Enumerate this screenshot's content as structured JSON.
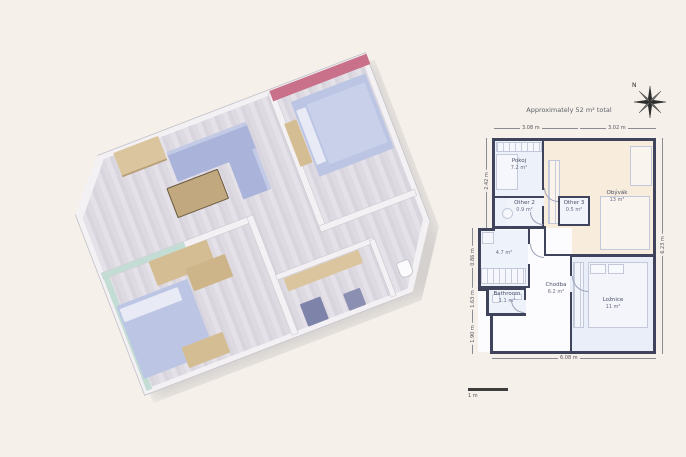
{
  "page": {
    "background": "#f5f1ea"
  },
  "plan2d": {
    "title": "Approximately 52 m² total",
    "compass_label": "N",
    "scale_label": "1 m",
    "rooms": [
      {
        "name": "Pokoj",
        "area": "7.2 m²"
      },
      {
        "name": "Obývák",
        "area": "13 m²"
      },
      {
        "name": "Other 2",
        "area": "0.9 m²"
      },
      {
        "name": "Other 3",
        "area": "0.5 m²"
      },
      {
        "name": "",
        "area": "4.7 m²"
      },
      {
        "name": "Chodba",
        "area": "6.2 m²"
      },
      {
        "name": "Bathroom",
        "area": "1.1 m²"
      },
      {
        "name": "Ložnice",
        "area": "11 m²"
      }
    ],
    "dimensions": {
      "top_left": "3.08 m",
      "top_right": "3.02 m",
      "bottom": "6.08 m",
      "right": "6.23 m",
      "left": [
        "2.42 m",
        "0.86 m",
        "1.63 m",
        "1.90 m"
      ]
    },
    "colors": {
      "wall": "#3f445c",
      "room_blue": "#edf2fa",
      "room_cream": "#f8ecdc"
    }
  },
  "plan3d": {
    "rooms": [
      "living-room",
      "bedroom-pink",
      "bedroom-teal",
      "hallway",
      "kitchen",
      "bathroom"
    ],
    "colors": {
      "accent_pink": "#c9718a",
      "accent_teal": "#c3dcd4",
      "floor": "#dcd9e1",
      "sofa": "#a9b3d9",
      "bed": "#bcc6e4",
      "wood": "#d5bd93",
      "appliance": "#7e84a9"
    }
  }
}
